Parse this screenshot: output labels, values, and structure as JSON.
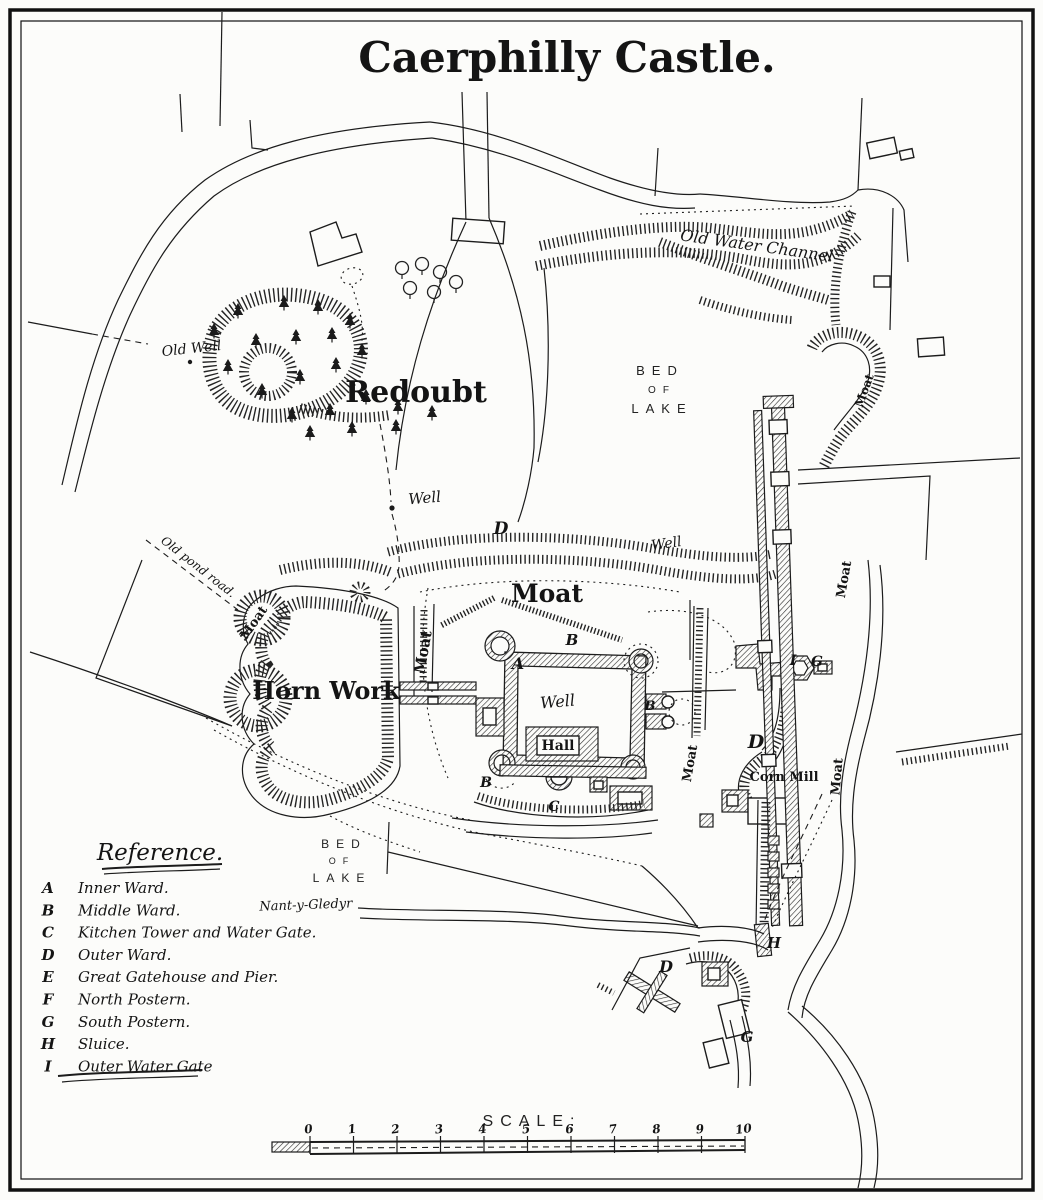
{
  "title": "Caerphilly Castle.",
  "map": {
    "labels": [
      {
        "id": "old-water-channel-label",
        "text": "Old Water Channel",
        "x": 756,
        "y": 251,
        "rotate": 8,
        "class": "script",
        "size": 16
      },
      {
        "id": "old-well-label",
        "text": "Old Well",
        "x": 192,
        "y": 353,
        "rotate": -6,
        "class": "script",
        "size": 14
      },
      {
        "id": "redoubt-label",
        "text": "Redoubt",
        "x": 416,
        "y": 402,
        "rotate": 0,
        "class": "blackletter",
        "size": 30
      },
      {
        "id": "bed-of-lake-north-line1",
        "text": "BED",
        "x": 660,
        "y": 375,
        "class": "caps",
        "size": 13
      },
      {
        "id": "bed-of-lake-north-line2",
        "text": "OF",
        "x": 662,
        "y": 393,
        "class": "caps",
        "size": 10
      },
      {
        "id": "bed-of-lake-north-line3",
        "text": "LAKE",
        "x": 662,
        "y": 413,
        "class": "caps",
        "size": 13
      },
      {
        "id": "well-redoubt-label",
        "text": "Well",
        "x": 425,
        "y": 503,
        "rotate": -5,
        "class": "script",
        "size": 15
      },
      {
        "id": "letter-d-north-moat",
        "text": "D",
        "x": 501,
        "y": 534,
        "class": "letter",
        "size": 17
      },
      {
        "id": "well-north-moat-label",
        "text": "Well",
        "x": 667,
        "y": 548,
        "rotate": -8,
        "class": "script",
        "size": 14
      },
      {
        "id": "moat-north-label",
        "text": "Moat",
        "x": 547,
        "y": 602,
        "class": "blackletter",
        "size": 25
      },
      {
        "id": "moat-west-inner-label",
        "text": "Moat",
        "x": 428,
        "y": 653,
        "rotate": -80,
        "class": "blackletter",
        "size": 15
      },
      {
        "id": "moat-hornwork-label",
        "text": "Moat",
        "x": 257,
        "y": 625,
        "rotate": -55,
        "class": "blackletter",
        "size": 13
      },
      {
        "id": "old-pond-road-label",
        "text": "Old pond road.",
        "x": 196,
        "y": 570,
        "rotate": 38,
        "class": "script",
        "size": 12
      },
      {
        "id": "horn-work-label",
        "text": "Horn Work",
        "x": 326,
        "y": 699,
        "class": "blackletter",
        "size": 24
      },
      {
        "id": "letter-a-inner-ward",
        "text": "A",
        "x": 518,
        "y": 669,
        "class": "letter",
        "size": 16
      },
      {
        "id": "letter-b-middle-north",
        "text": "B",
        "x": 572,
        "y": 645,
        "class": "letter",
        "size": 15
      },
      {
        "id": "well-inner-ward-label",
        "text": "Well",
        "x": 558,
        "y": 707,
        "rotate": -5,
        "class": "script",
        "size": 16
      },
      {
        "id": "letter-b-east",
        "text": "B",
        "x": 650,
        "y": 710,
        "class": "letter",
        "size": 13
      },
      {
        "id": "hall-label",
        "text": "Hall",
        "x": 558,
        "y": 750,
        "class": "blackletter",
        "size": 14
      },
      {
        "id": "letter-b-southwest",
        "text": "B",
        "x": 486,
        "y": 787,
        "class": "letter",
        "size": 14
      },
      {
        "id": "letter-c-south",
        "text": "C",
        "x": 554,
        "y": 811,
        "class": "letter",
        "size": 14
      },
      {
        "id": "moat-east-castle-label",
        "text": "Moat",
        "x": 694,
        "y": 764,
        "rotate": -80,
        "class": "blackletter",
        "size": 13
      },
      {
        "id": "letter-d-outer-ward",
        "text": "D",
        "x": 756,
        "y": 748,
        "class": "letter",
        "size": 19
      },
      {
        "id": "corn-mill-label",
        "text": "Corn Mill",
        "x": 784,
        "y": 781,
        "class": "blackletter",
        "size": 13
      },
      {
        "id": "letter-i-outer-gate",
        "text": "I",
        "x": 793,
        "y": 665,
        "class": "letter",
        "size": 14
      },
      {
        "id": "letter-g-south-postern",
        "text": "G",
        "x": 817,
        "y": 666,
        "class": "letter",
        "size": 14
      },
      {
        "id": "moat-east-dam-label",
        "text": "Moat",
        "x": 848,
        "y": 580,
        "rotate": -80,
        "class": "blackletter",
        "size": 13
      },
      {
        "id": "moat-northeast-label",
        "text": "Moat",
        "x": 868,
        "y": 392,
        "rotate": -70,
        "class": "blackletter",
        "size": 12
      },
      {
        "id": "moat-southeast-label",
        "text": "Moat",
        "x": 841,
        "y": 777,
        "rotate": -85,
        "class": "blackletter",
        "size": 13
      },
      {
        "id": "bed-of-lake-south-line1",
        "text": "BED",
        "x": 344,
        "y": 848,
        "class": "caps",
        "size": 12
      },
      {
        "id": "bed-of-lake-south-line2",
        "text": "OF",
        "x": 342,
        "y": 864,
        "class": "caps",
        "size": 9
      },
      {
        "id": "bed-of-lake-south-line3",
        "text": "LAKE",
        "x": 342,
        "y": 882,
        "class": "caps",
        "size": 12
      },
      {
        "id": "nant-y-gledyr-label",
        "text": "Nant-y-Gledyr",
        "x": 306,
        "y": 909,
        "rotate": -2,
        "class": "script",
        "size": 13
      },
      {
        "id": "letter-h-sluice",
        "text": "H",
        "x": 774,
        "y": 948,
        "class": "letter",
        "size": 15
      },
      {
        "id": "letter-d-south",
        "text": "D",
        "x": 666,
        "y": 972,
        "class": "letter",
        "size": 16
      },
      {
        "id": "letter-g-south",
        "text": "G",
        "x": 747,
        "y": 1042,
        "class": "letter",
        "size": 15
      }
    ]
  },
  "reference": {
    "heading": "Reference.",
    "items": [
      {
        "key": "A",
        "label": "Inner Ward."
      },
      {
        "key": "B",
        "label": "Middle Ward."
      },
      {
        "key": "C",
        "label": "Kitchen Tower and Water Gate."
      },
      {
        "key": "D",
        "label": "Outer Ward."
      },
      {
        "key": "E",
        "label": "Great Gatehouse and Pier."
      },
      {
        "key": "F",
        "label": "North Postern."
      },
      {
        "key": "G",
        "label": "South Postern."
      },
      {
        "key": "H",
        "label": "Sluice."
      },
      {
        "key": "I",
        "label": "Outer Water Gate"
      }
    ]
  },
  "scale": {
    "heading": "SCALE:",
    "ticks": [
      "0",
      "1",
      "2",
      "3",
      "4",
      "5",
      "6",
      "7",
      "8",
      "9",
      "10"
    ]
  }
}
